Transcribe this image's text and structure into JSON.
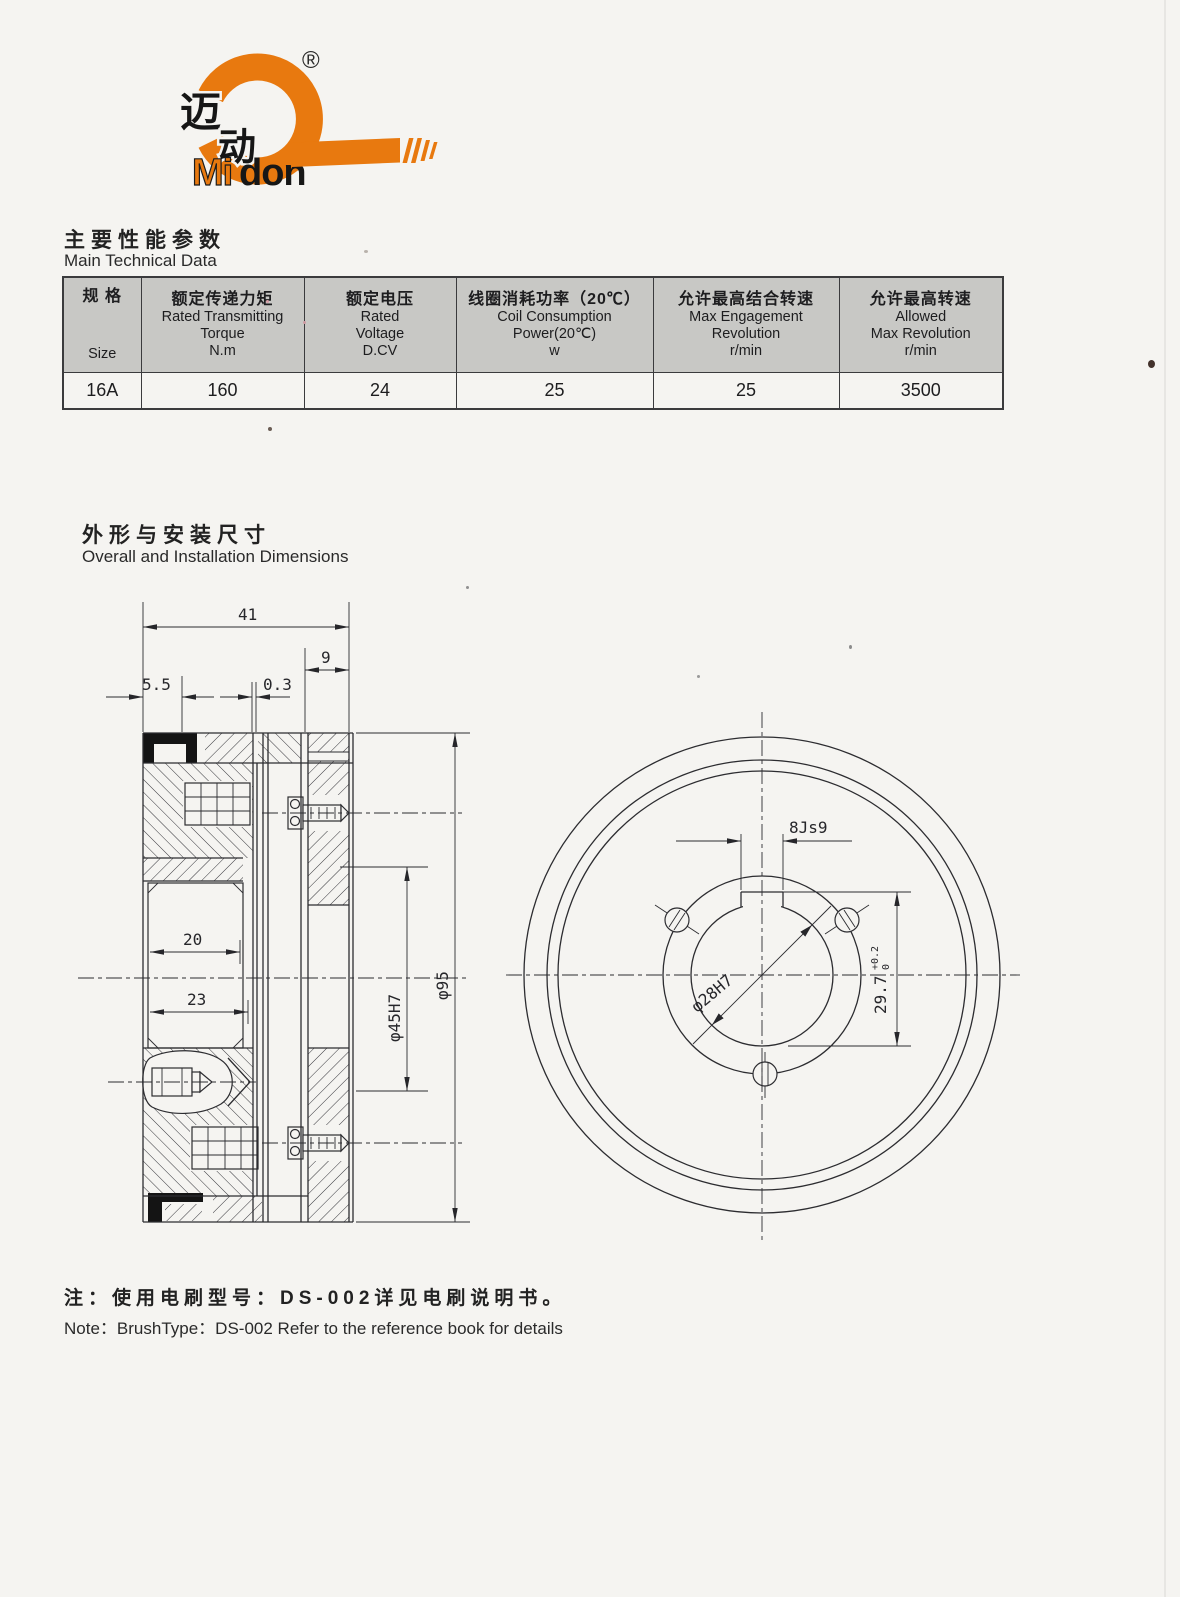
{
  "colors": {
    "orange": "#e8790f",
    "ink": "#1d1d1f",
    "table_header_bg": "#c8c8c5",
    "page_bg": "#f5f4f1"
  },
  "logo": {
    "registered": "®",
    "cn_char_1": "迈",
    "cn_char_2": "动",
    "brand_mi": "Mi",
    "brand_don": "don"
  },
  "tech_section": {
    "title_zh": "主要性能参数",
    "title_en": "Main Technical Data"
  },
  "table": {
    "col_size": {
      "zh": "规  格",
      "en": "Size"
    },
    "col_torque": {
      "zh": "额定传递力矩",
      "en1": "Rated Transmitting",
      "en2": "Torque",
      "unit": "N.m"
    },
    "col_voltage": {
      "zh": "额定电压",
      "en1": "Rated",
      "en2": "Voltage",
      "unit": "D.CV"
    },
    "col_power": {
      "zh": "线圈消耗功率（20℃）",
      "en1": "Coil Consumption",
      "en2": "Power(20℃)",
      "unit": "w"
    },
    "col_engage": {
      "zh": "允许最高结合转速",
      "en1": "Max Engagement",
      "en2": "Revolution",
      "unit": "r/min"
    },
    "col_max": {
      "zh": "允许最高转速",
      "en1": "Allowed",
      "en2": "Max Revolution",
      "unit": "r/min"
    },
    "row": {
      "size": "16A",
      "torque": "160",
      "voltage": "24",
      "power": "25",
      "engage": "25",
      "max": "3500"
    }
  },
  "dims_section": {
    "title_zh": "外形与安装尺寸",
    "title_en": "Overall and Installation Dimensions"
  },
  "drawing": {
    "d41": "41",
    "d9": "9",
    "d55": "5.5",
    "d03": "0.3",
    "d20": "20",
    "d23": "23",
    "d45": "φ45H7",
    "d95": "φ95",
    "key": "8Js9",
    "bore": "φ28H7",
    "height": "29.7",
    "tol_upper": "+0.2",
    "tol_lower": "0"
  },
  "note": {
    "zh": "注：使用电刷型号：DS-002详见电刷说明书。",
    "en": "Note：BrushType：DS-002 Refer to the reference book for details"
  }
}
